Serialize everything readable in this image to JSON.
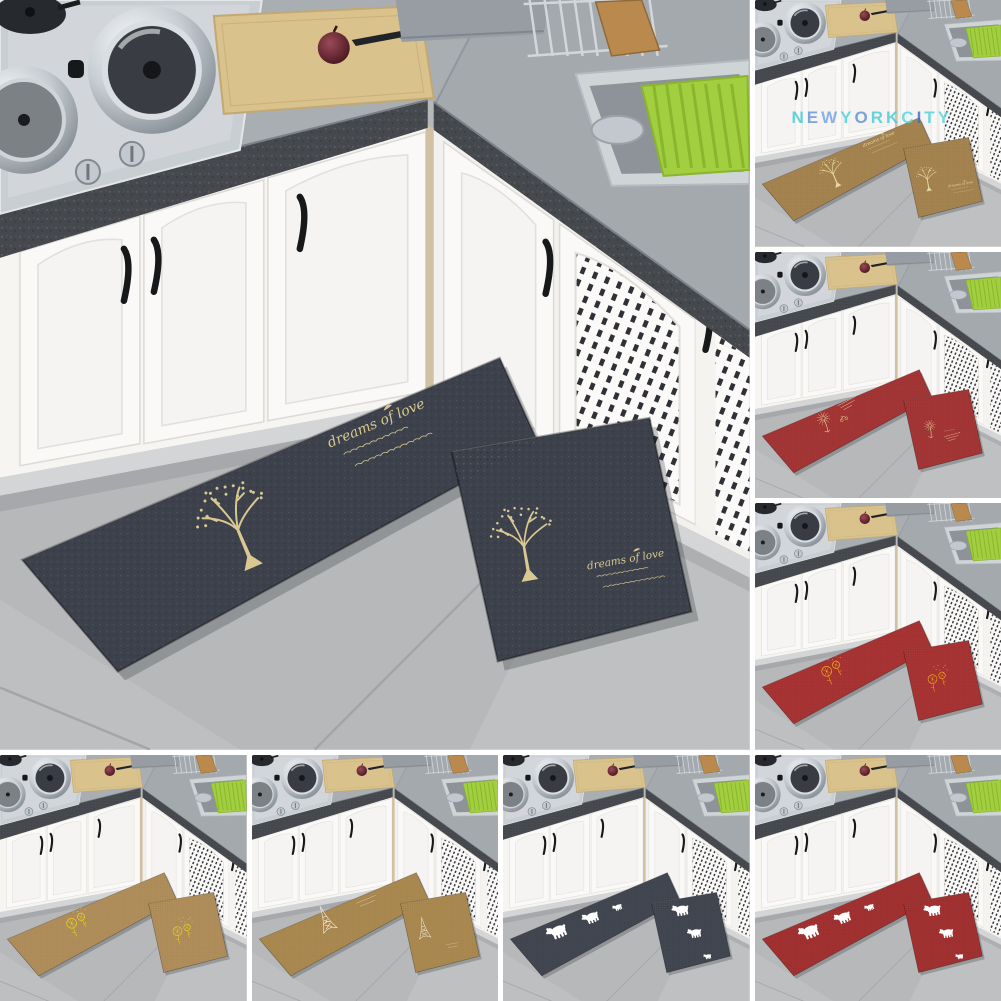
{
  "image_type": "product-photo-collage",
  "watermark": {
    "text": "NEWYORKCITY",
    "letters": [
      {
        "ch": "N",
        "color": "#45c8d6"
      },
      {
        "ch": "E",
        "color": "#6496da"
      },
      {
        "ch": "W",
        "color": "#74a4e2"
      },
      {
        "ch": "Y",
        "color": "#4cd0dc"
      },
      {
        "ch": "O",
        "color": "#5e90d6"
      },
      {
        "ch": "R",
        "color": "#49cbd8"
      },
      {
        "ch": "K",
        "color": "#41cdd9"
      },
      {
        "ch": "C",
        "color": "#54d5e0"
      },
      {
        "ch": "I",
        "color": "#3f6ec0"
      },
      {
        "ch": "T",
        "color": "#4fd0da"
      },
      {
        "ch": "Y",
        "color": "#56d7de"
      }
    ]
  },
  "mat_text": {
    "title": "dreams of love"
  },
  "scene": {
    "floor": "#b6b8ba",
    "floor_light": "#c5c6c7",
    "grout": "#a3a5a8",
    "counter": "#a9aeb2",
    "counter_right": "#a4a9ad",
    "granite": "#45494e",
    "granite_fleck_light": "#60656b",
    "granite_fleck_dark": "#313438",
    "cabinet": "#f6f5f2",
    "cabinet_right": "#f2f1ee",
    "door_face": "#faf9f7",
    "panel_line": "#e2e0dc",
    "kick": "#d4d5d6",
    "handle": "#17181a",
    "lattice_hole": "#2e3136",
    "corner_strip": "#d0c1a2",
    "stove_plate": "#c9ced2",
    "burner": "#2b2e32",
    "steel_hi": "#f6f8fa",
    "steel_mid": "#c6ccd1",
    "steel_dark": "#878f96",
    "lid_glass": "#393d43",
    "cutting_board": "#d9c28c",
    "board_edge": "#c3a873",
    "onion_hi": "#9a4a58",
    "onion_dark": "#401018",
    "knife": "#202327",
    "appliance": "#979da2",
    "rack_wire": "#d2d7db",
    "rack_board": "#b9894d",
    "sink_rim": "#cfd4d7",
    "sink_basin": "#8d9398",
    "basket_green": "#a2cf40",
    "basket_slat": "#8ab52e"
  },
  "tiles": [
    {
      "id": "main-dark-tree",
      "mat_color": "#3c414b",
      "design": "tree",
      "design_color": "#d9c892",
      "watermark": false
    },
    {
      "id": "brown-tree",
      "mat_color": "#a3824e",
      "design": "tree",
      "design_color": "#e6d8a4",
      "watermark": true
    },
    {
      "id": "red-dandelion-sparkle",
      "mat_color": "#a23434",
      "design": "dandelion-lines",
      "design_color": "#ecdca6",
      "watermark": false
    },
    {
      "id": "red-dandelion-circles",
      "mat_color": "#a63232",
      "design": "dandelion-circles",
      "design_color": "#f0a81c",
      "watermark": false
    },
    {
      "id": "tan-dandelion-circles",
      "mat_color": "#af8d5a",
      "design": "dandelion-circles",
      "design_color": "#e8d21c",
      "watermark": false
    },
    {
      "id": "tan-eiffel",
      "mat_color": "#a9884f",
      "design": "eiffel",
      "design_color": "#f5efdf",
      "watermark": false
    },
    {
      "id": "dark-polar-bears",
      "mat_color": "#40454f",
      "design": "bears",
      "design_color": "#ffffff",
      "watermark": false
    },
    {
      "id": "red-polar-bears",
      "mat_color": "#a03030",
      "design": "bears",
      "design_color": "#ffffff",
      "watermark": false
    }
  ]
}
